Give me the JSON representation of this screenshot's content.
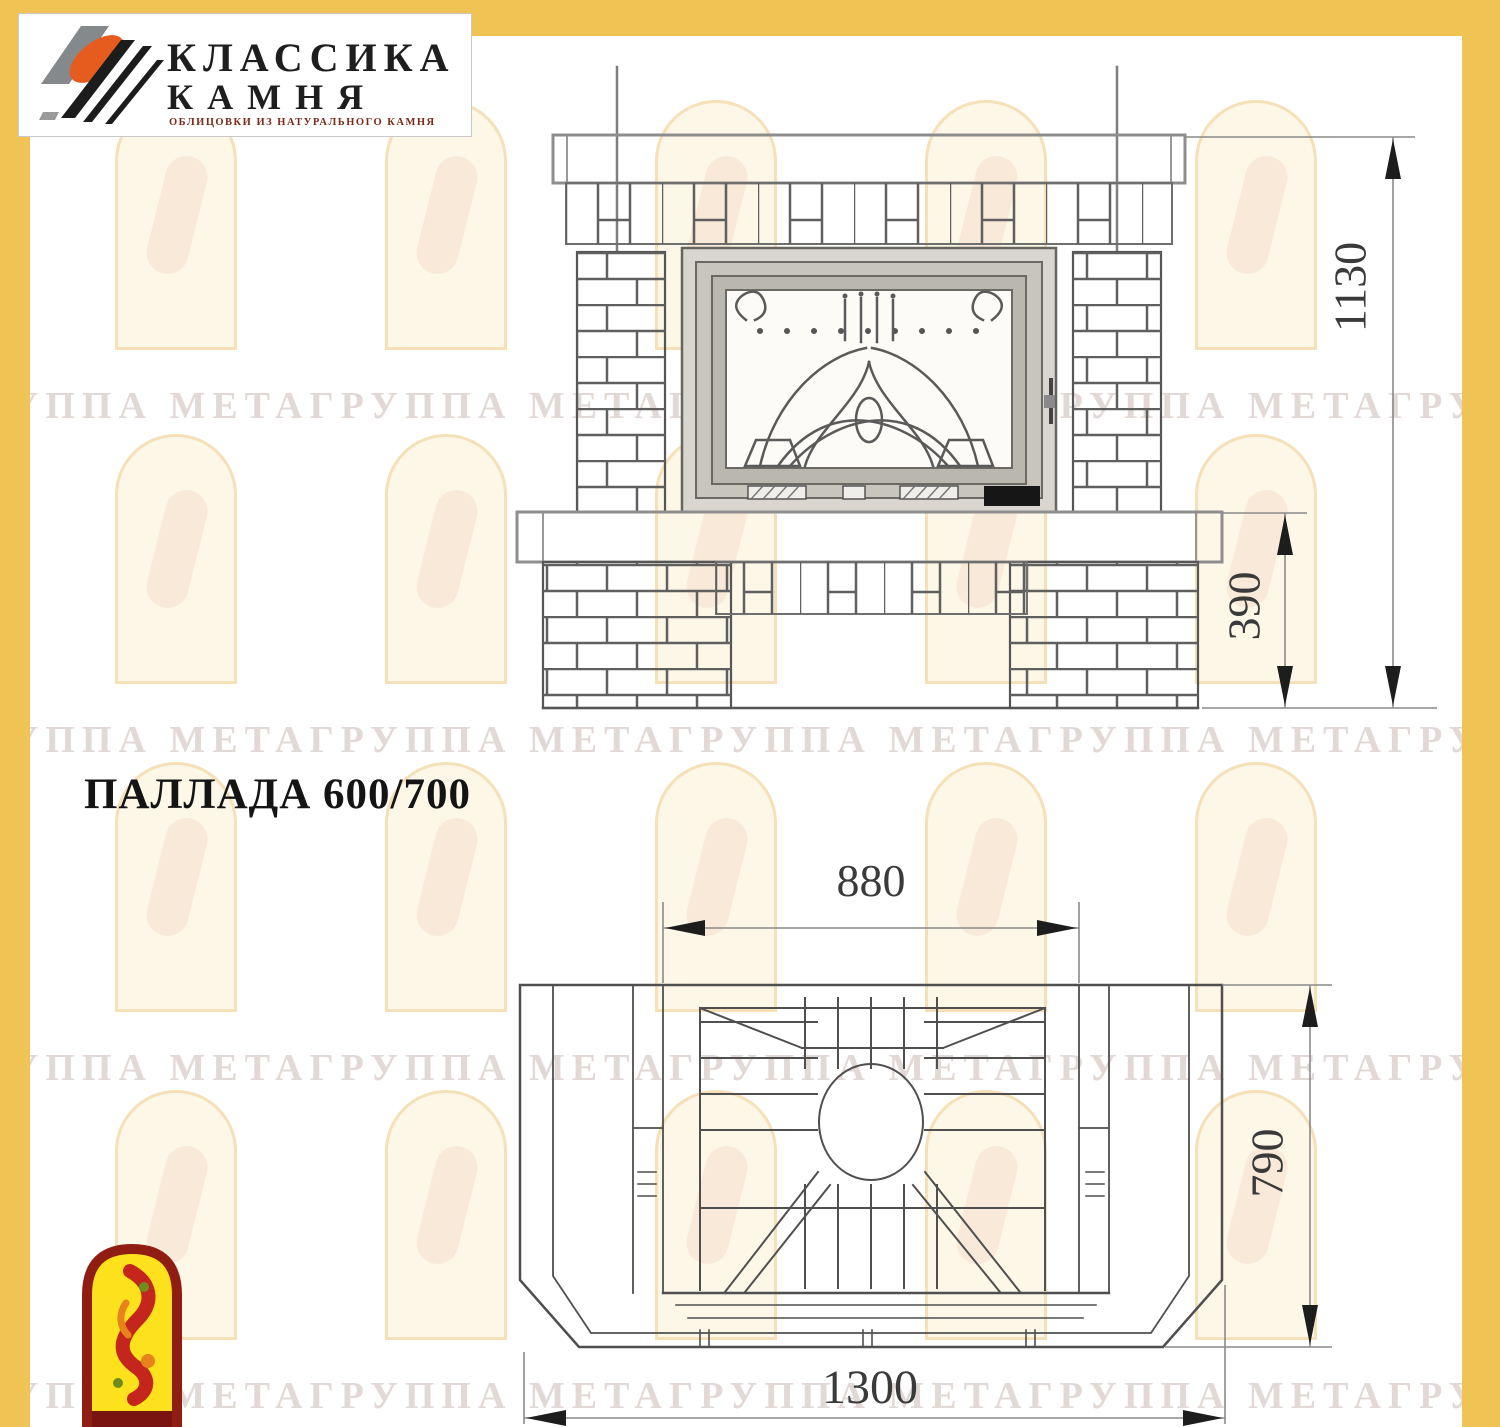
{
  "page": {
    "width": 1500,
    "height": 1427,
    "background": "#ffffff",
    "frame_color": "#f0c355"
  },
  "header_logo": {
    "line1": "КЛАССИКА",
    "line2": "КАМНЯ",
    "subtitle": "ОБЛИЦОВКИ ИЗ НАТУРАЛЬНОГО КАМНЯ"
  },
  "title": "ПАЛЛАДА 600/700",
  "watermark": {
    "text": "ГРУППА МЕТАГРУППА МЕТАГРУППА МЕТАГРУППА МЕТАГРУППА МЕТАГРУППА МЕТА"
  },
  "drawing": {
    "front_view": {
      "label": "front-elevation-of-fireplace",
      "dims": {
        "height_total": "1130",
        "plinth_height": "390"
      }
    },
    "plan_view": {
      "label": "top-plan-of-fireplace",
      "dims": {
        "top_width": "880",
        "depth": "790",
        "total_width": "1300"
      }
    }
  },
  "colors": {
    "frame_yellow": "#f0c355",
    "line_dark": "#4f4f4f",
    "line_gray": "#8e8e8e",
    "dimension_text": "#3a3a3a",
    "firebox_steel": "#d8d6ce",
    "logo_orange": "#e65c1e",
    "flame_logo_red": "#8f1d12",
    "flame_logo_yellow": "#fce11c"
  }
}
